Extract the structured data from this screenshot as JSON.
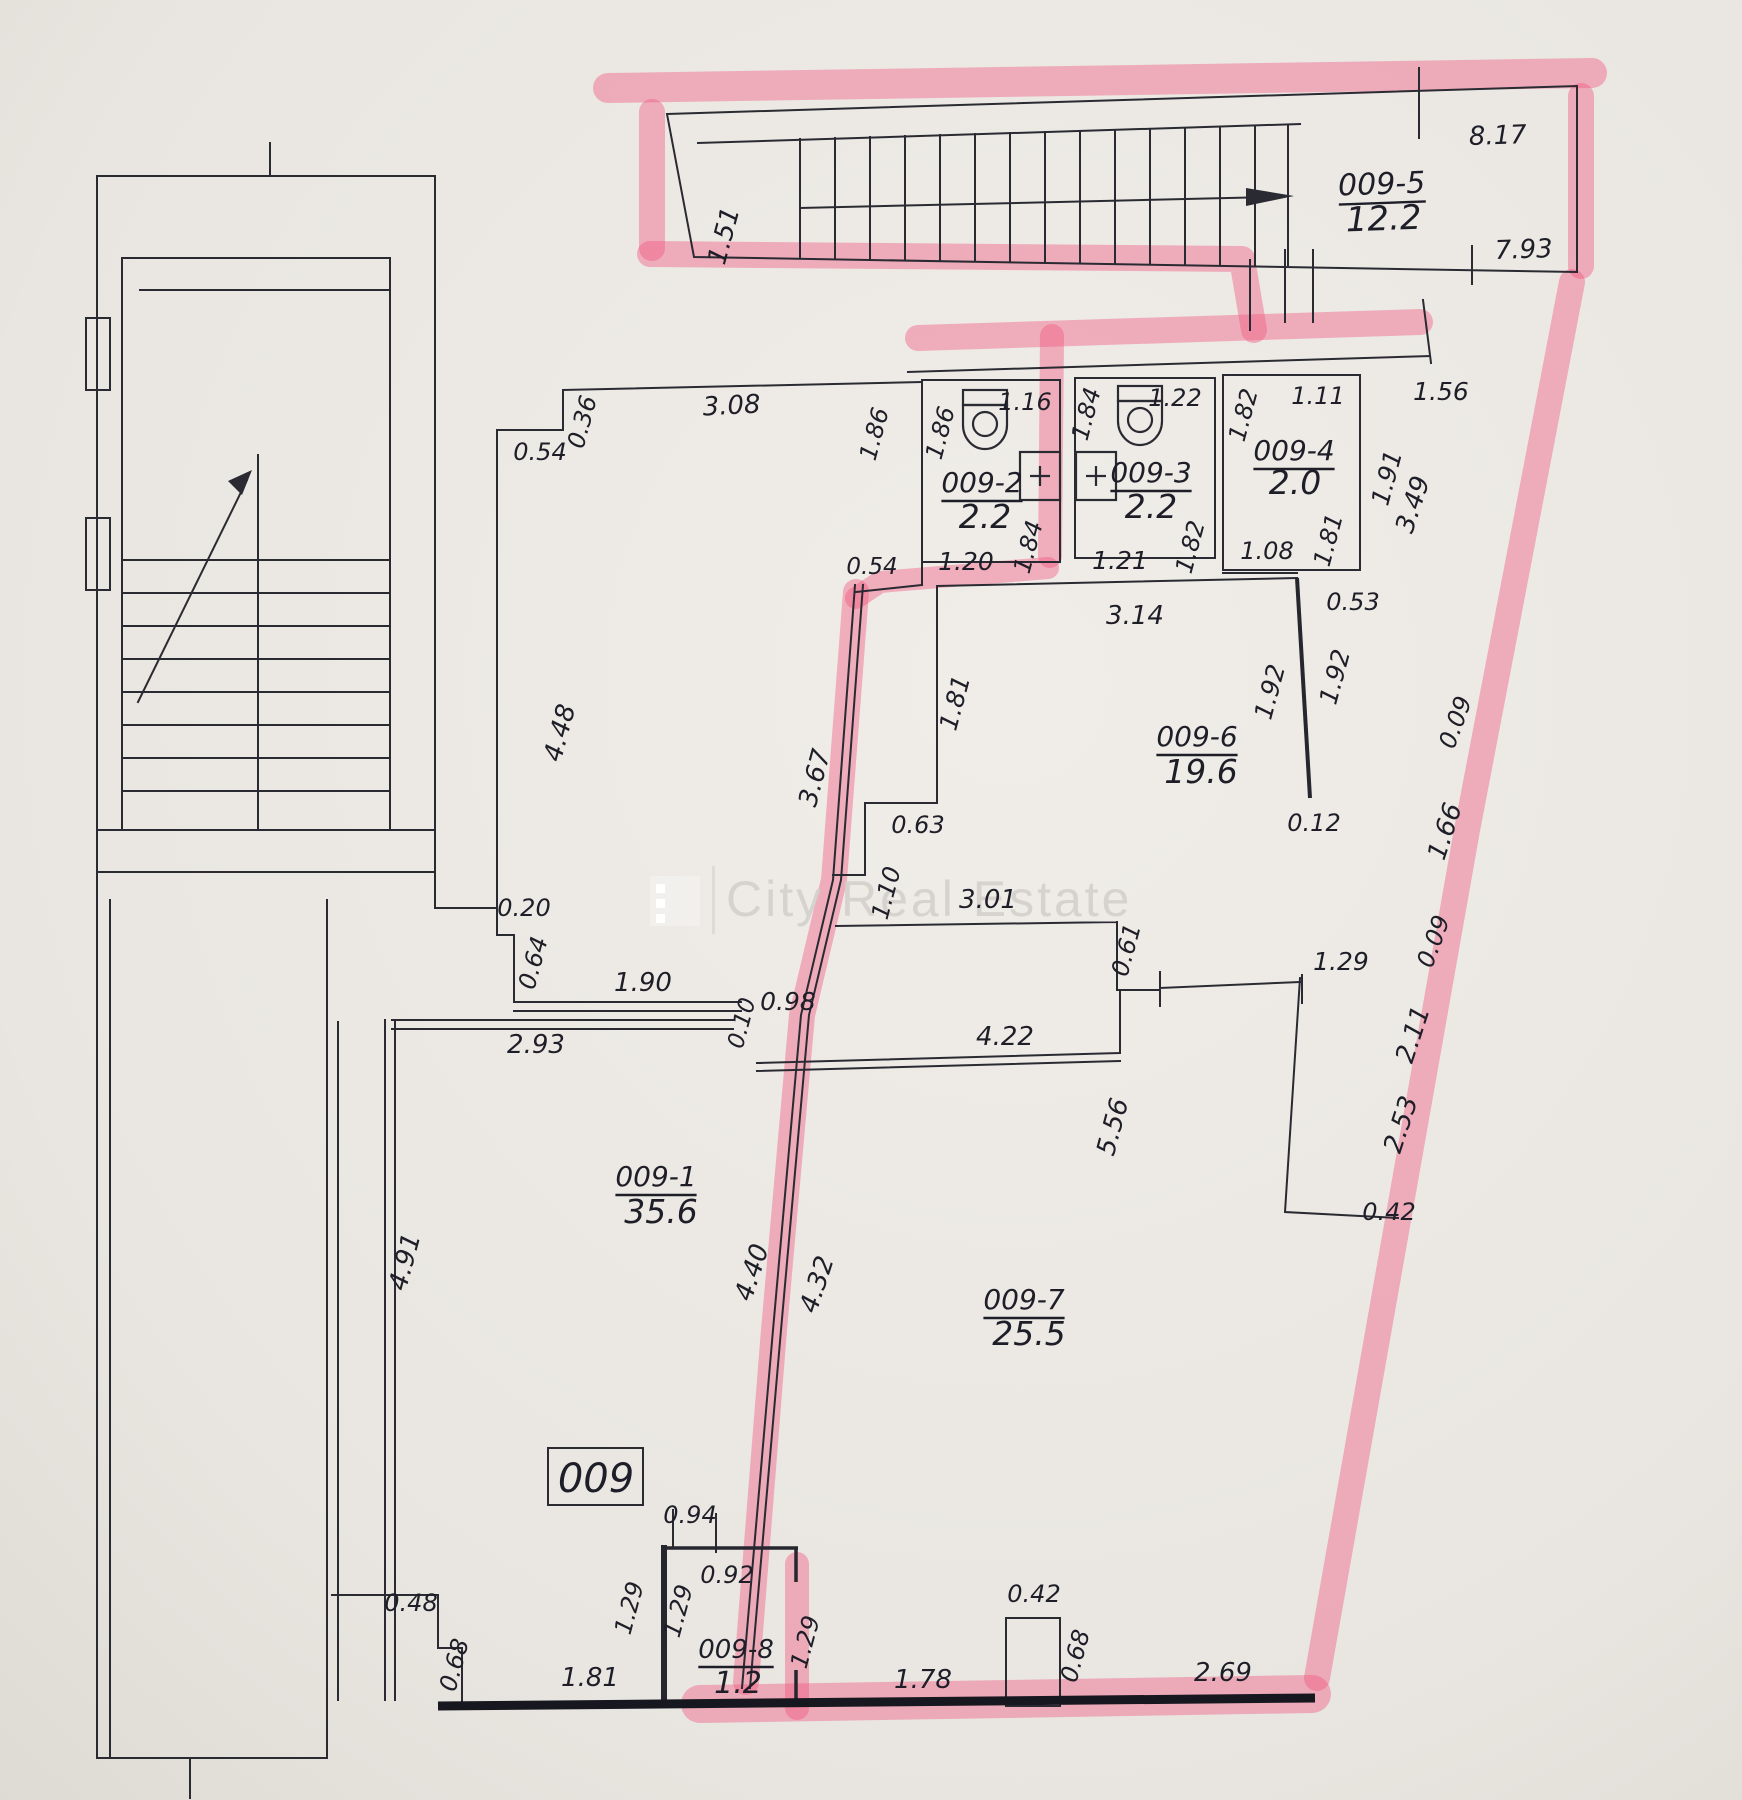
{
  "watermark": {
    "logo": "city-real-estate-logo",
    "text": "City Real Estate"
  },
  "unit_box": {
    "label": "009"
  },
  "rooms": [
    {
      "id": "009-1",
      "area_m2": "35.6"
    },
    {
      "id": "009-2",
      "area_m2": "2.2"
    },
    {
      "id": "009-3",
      "area_m2": "2.2"
    },
    {
      "id": "009-4",
      "area_m2": "2.0"
    },
    {
      "id": "009-5",
      "area_m2": "12.2"
    },
    {
      "id": "009-6",
      "area_m2": "19.6"
    },
    {
      "id": "009-7",
      "area_m2": "25.5"
    },
    {
      "id": "009-8",
      "area_m2": "1.2"
    }
  ],
  "plan": {
    "labels": [
      {
        "t": "1.51",
        "x": 732,
        "y": 238,
        "s": 26,
        "r": -75
      },
      {
        "t": "8.17",
        "x": 1498,
        "y": 144,
        "s": 26,
        "r": -2
      },
      {
        "t": "009-5",
        "x": 1382,
        "y": 194,
        "s": 30,
        "r": -2,
        "k": "room",
        "u": 1
      },
      {
        "t": "12.2",
        "x": 1384,
        "y": 230,
        "s": 34,
        "r": -2,
        "k": "area"
      },
      {
        "t": "7.93",
        "x": 1524,
        "y": 258,
        "s": 26,
        "r": -2
      },
      {
        "t": "0.36",
        "x": 590,
        "y": 424,
        "s": 24,
        "r": -75
      },
      {
        "t": "0.54",
        "x": 540,
        "y": 460,
        "s": 24
      },
      {
        "t": "3.08",
        "x": 732,
        "y": 414,
        "s": 26,
        "r": -3
      },
      {
        "t": "4.48",
        "x": 568,
        "y": 735,
        "s": 26,
        "r": -75
      },
      {
        "t": "0.20",
        "x": 524,
        "y": 916,
        "s": 24
      },
      {
        "t": "0.64",
        "x": 541,
        "y": 965,
        "s": 24,
        "r": -75
      },
      {
        "t": "1.90",
        "x": 643,
        "y": 991,
        "s": 26
      },
      {
        "t": "1.86",
        "x": 882,
        "y": 436,
        "s": 24,
        "r": -75
      },
      {
        "t": "1.86",
        "x": 948,
        "y": 435,
        "s": 24,
        "r": -75
      },
      {
        "t": "1.16",
        "x": 1025,
        "y": 410,
        "s": 24
      },
      {
        "t": "009-2",
        "x": 982,
        "y": 492,
        "s": 28,
        "k": "room",
        "u": 1
      },
      {
        "t": "2.2",
        "x": 985,
        "y": 528,
        "s": 33,
        "k": "area"
      },
      {
        "t": "0.54",
        "x": 872,
        "y": 574,
        "s": 23
      },
      {
        "t": "1.20",
        "x": 966,
        "y": 570,
        "s": 25
      },
      {
        "t": "1.84",
        "x": 1036,
        "y": 549,
        "s": 24,
        "r": -75
      },
      {
        "t": "1.84",
        "x": 1094,
        "y": 416,
        "s": 24,
        "r": -75
      },
      {
        "t": "1.22",
        "x": 1175,
        "y": 406,
        "s": 24
      },
      {
        "t": "009-3",
        "x": 1151,
        "y": 482,
        "s": 28,
        "k": "room",
        "u": 1
      },
      {
        "t": "2.2",
        "x": 1151,
        "y": 518,
        "s": 33,
        "k": "area"
      },
      {
        "t": "1.21",
        "x": 1120,
        "y": 569,
        "s": 25
      },
      {
        "t": "1.82",
        "x": 1198,
        "y": 549,
        "s": 24,
        "r": -75
      },
      {
        "t": "1.82",
        "x": 1251,
        "y": 417,
        "s": 24,
        "r": -75
      },
      {
        "t": "1.11",
        "x": 1318,
        "y": 404,
        "s": 24
      },
      {
        "t": "009-4",
        "x": 1294,
        "y": 460,
        "s": 28,
        "k": "room",
        "u": 1
      },
      {
        "t": "2.0",
        "x": 1295,
        "y": 494,
        "s": 33,
        "k": "area"
      },
      {
        "t": "1.08",
        "x": 1267,
        "y": 559,
        "s": 24
      },
      {
        "t": "1.81",
        "x": 1336,
        "y": 542,
        "s": 24,
        "r": -75
      },
      {
        "t": "1.91",
        "x": 1395,
        "y": 480,
        "s": 25,
        "r": -75
      },
      {
        "t": "1.56",
        "x": 1441,
        "y": 400,
        "s": 25
      },
      {
        "t": "3.14",
        "x": 1135,
        "y": 624,
        "s": 26
      },
      {
        "t": "0.53",
        "x": 1353,
        "y": 610,
        "s": 24
      },
      {
        "t": "1.81",
        "x": 963,
        "y": 705,
        "s": 25,
        "r": -75
      },
      {
        "t": "1.92",
        "x": 1278,
        "y": 694,
        "s": 25,
        "r": -75
      },
      {
        "t": "1.92",
        "x": 1343,
        "y": 679,
        "s": 25,
        "r": -75
      },
      {
        "t": "009-6",
        "x": 1197,
        "y": 746,
        "s": 28,
        "k": "room",
        "u": 1
      },
      {
        "t": "19.6",
        "x": 1201,
        "y": 783,
        "s": 33,
        "k": "area"
      },
      {
        "t": "0.12",
        "x": 1314,
        "y": 831,
        "s": 24
      },
      {
        "t": "0.63",
        "x": 918,
        "y": 833,
        "s": 24
      },
      {
        "t": "3.67",
        "x": 823,
        "y": 780,
        "s": 26,
        "r": -75
      },
      {
        "t": "1.10",
        "x": 894,
        "y": 895,
        "s": 24,
        "r": -75
      },
      {
        "t": "3.01",
        "x": 988,
        "y": 908,
        "s": 26
      },
      {
        "t": "0.61",
        "x": 1134,
        "y": 952,
        "s": 24,
        "r": -75
      },
      {
        "t": "3.49",
        "x": 1421,
        "y": 507,
        "s": 26,
        "r": -72
      },
      {
        "t": "0.09",
        "x": 1463,
        "y": 725,
        "s": 24,
        "r": -70
      },
      {
        "t": "1.66",
        "x": 1453,
        "y": 834,
        "s": 26,
        "r": -72
      },
      {
        "t": "0.09",
        "x": 1441,
        "y": 944,
        "s": 24,
        "r": -70
      },
      {
        "t": "1.29",
        "x": 1341,
        "y": 970,
        "s": 25
      },
      {
        "t": "2.11",
        "x": 1421,
        "y": 1037,
        "s": 26,
        "r": -72
      },
      {
        "t": "2.53",
        "x": 1409,
        "y": 1127,
        "s": 26,
        "r": -72
      },
      {
        "t": "0.42",
        "x": 1389,
        "y": 1220,
        "s": 24
      },
      {
        "t": "0.98",
        "x": 788,
        "y": 1010,
        "s": 25
      },
      {
        "t": "0.10",
        "x": 749,
        "y": 1025,
        "s": 23,
        "r": -75
      },
      {
        "t": "2.93",
        "x": 536,
        "y": 1053,
        "s": 26
      },
      {
        "t": "009-1",
        "x": 656,
        "y": 1186,
        "s": 28,
        "k": "room",
        "u": 1
      },
      {
        "t": "35.6",
        "x": 661,
        "y": 1223,
        "s": 33,
        "k": "area"
      },
      {
        "t": "4.91",
        "x": 413,
        "y": 1264,
        "s": 26,
        "r": -75
      },
      {
        "t": "4.22",
        "x": 1005,
        "y": 1045,
        "s": 26
      },
      {
        "t": "5.56",
        "x": 1121,
        "y": 1129,
        "s": 26,
        "r": -75
      },
      {
        "t": "4.40",
        "x": 760,
        "y": 1275,
        "s": 26,
        "r": -72
      },
      {
        "t": "4.32",
        "x": 825,
        "y": 1287,
        "s": 26,
        "r": -72
      },
      {
        "t": "009-7",
        "x": 1024,
        "y": 1309,
        "s": 28,
        "k": "room",
        "u": 1
      },
      {
        "t": "25.5",
        "x": 1029,
        "y": 1345,
        "s": 33,
        "k": "area"
      },
      {
        "t": "0.94",
        "x": 690,
        "y": 1523,
        "s": 24
      },
      {
        "t": "0.92",
        "x": 727,
        "y": 1583,
        "s": 24
      },
      {
        "t": "0.48",
        "x": 411,
        "y": 1611,
        "s": 24
      },
      {
        "t": "1.29",
        "x": 637,
        "y": 1610,
        "s": 24,
        "r": -75
      },
      {
        "t": "1.29",
        "x": 686,
        "y": 1613,
        "s": 24,
        "r": -75
      },
      {
        "t": "0.68",
        "x": 462,
        "y": 1667,
        "s": 24,
        "r": -75
      },
      {
        "t": "1.81",
        "x": 590,
        "y": 1686,
        "s": 26
      },
      {
        "t": "009-8",
        "x": 736,
        "y": 1658,
        "s": 26,
        "k": "room",
        "u": 1
      },
      {
        "t": "1.2",
        "x": 738,
        "y": 1693,
        "s": 30,
        "k": "area"
      },
      {
        "t": "1.29",
        "x": 813,
        "y": 1644,
        "s": 24,
        "r": -75
      },
      {
        "t": "1.78",
        "x": 923,
        "y": 1688,
        "s": 26
      },
      {
        "t": "0.42",
        "x": 1034,
        "y": 1602,
        "s": 24
      },
      {
        "t": "0.68",
        "x": 1083,
        "y": 1658,
        "s": 24,
        "r": -75
      },
      {
        "t": "2.69",
        "x": 1223,
        "y": 1681,
        "s": 26
      }
    ]
  }
}
